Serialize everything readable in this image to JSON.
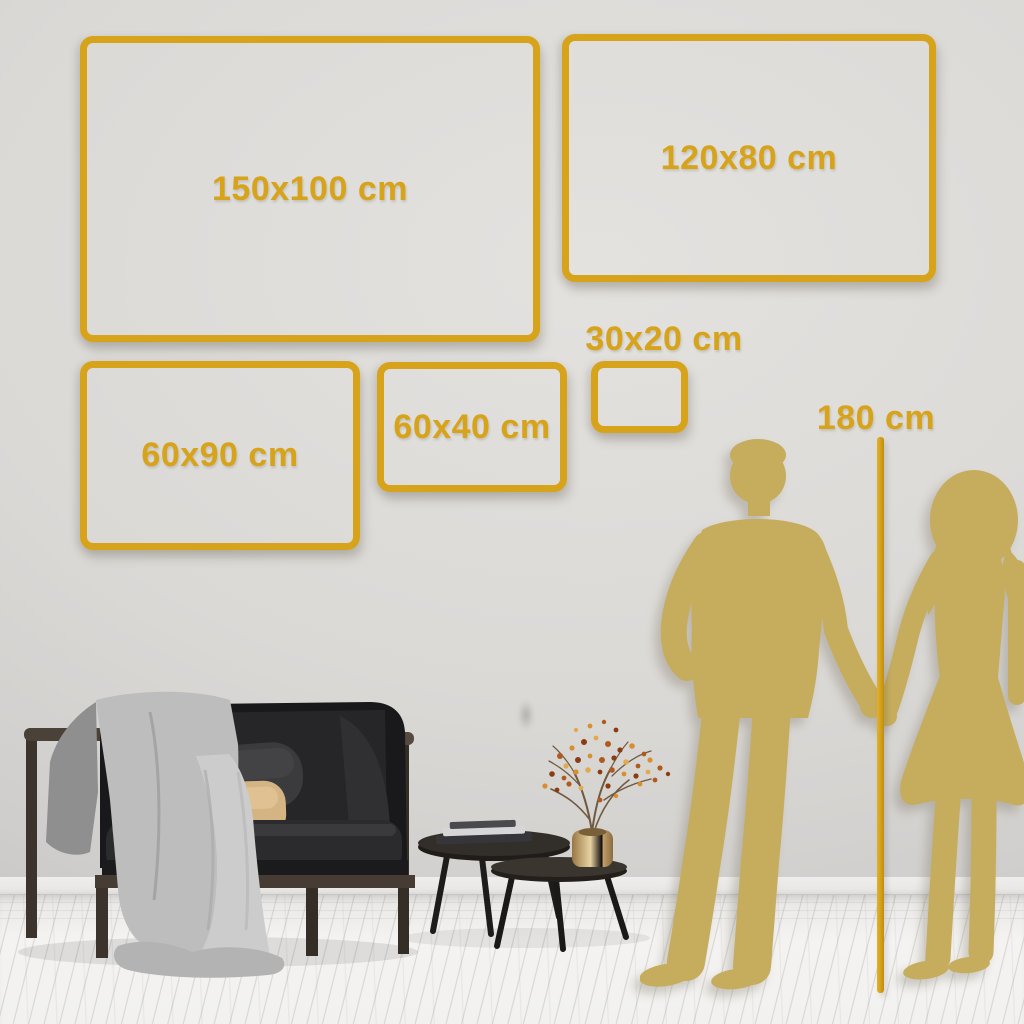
{
  "frames": {
    "items": [
      {
        "label": "150x100 cm",
        "width_cm": 150,
        "height_cm": 100
      },
      {
        "label": "120x80 cm",
        "width_cm": 120,
        "height_cm": 80
      },
      {
        "label": "60x90 cm",
        "width_cm": 60,
        "height_cm": 90
      },
      {
        "label": "60x40 cm",
        "width_cm": 60,
        "height_cm": 40
      },
      {
        "label": "30x20 cm",
        "width_cm": 30,
        "height_cm": 20
      }
    ]
  },
  "height_reference": {
    "label": "180 cm",
    "value_cm": 180
  },
  "colors": {
    "accent_gold": "#D7A31A",
    "silhouette_gold": "#C6AC5D",
    "wall": "#DBD9D6",
    "floor": "#F3F2F0"
  },
  "scene": {
    "description_elements": [
      "sofa",
      "blanket",
      "pillows",
      "coffee-tables",
      "brass-vase",
      "dried-branch",
      "couple-silhouette"
    ]
  }
}
